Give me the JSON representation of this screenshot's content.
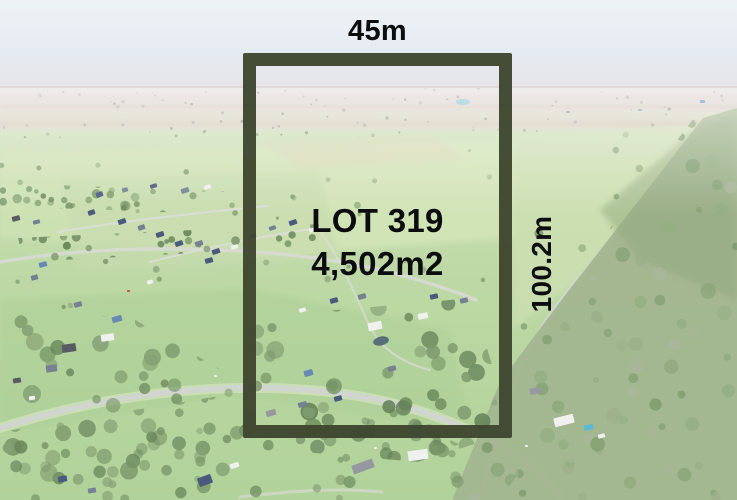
{
  "overlay": {
    "width_label": "45m",
    "depth_label": "100.2m",
    "lot_number": "LOT 319",
    "lot_area": "4,502m2",
    "colors": {
      "boundary_outline": "#3f472f",
      "label_text": "#0c0d0e",
      "sky": "#e7edf3",
      "grass": "#b7d59d",
      "forest": "#9cb087",
      "pool": "#49b4d6"
    }
  }
}
